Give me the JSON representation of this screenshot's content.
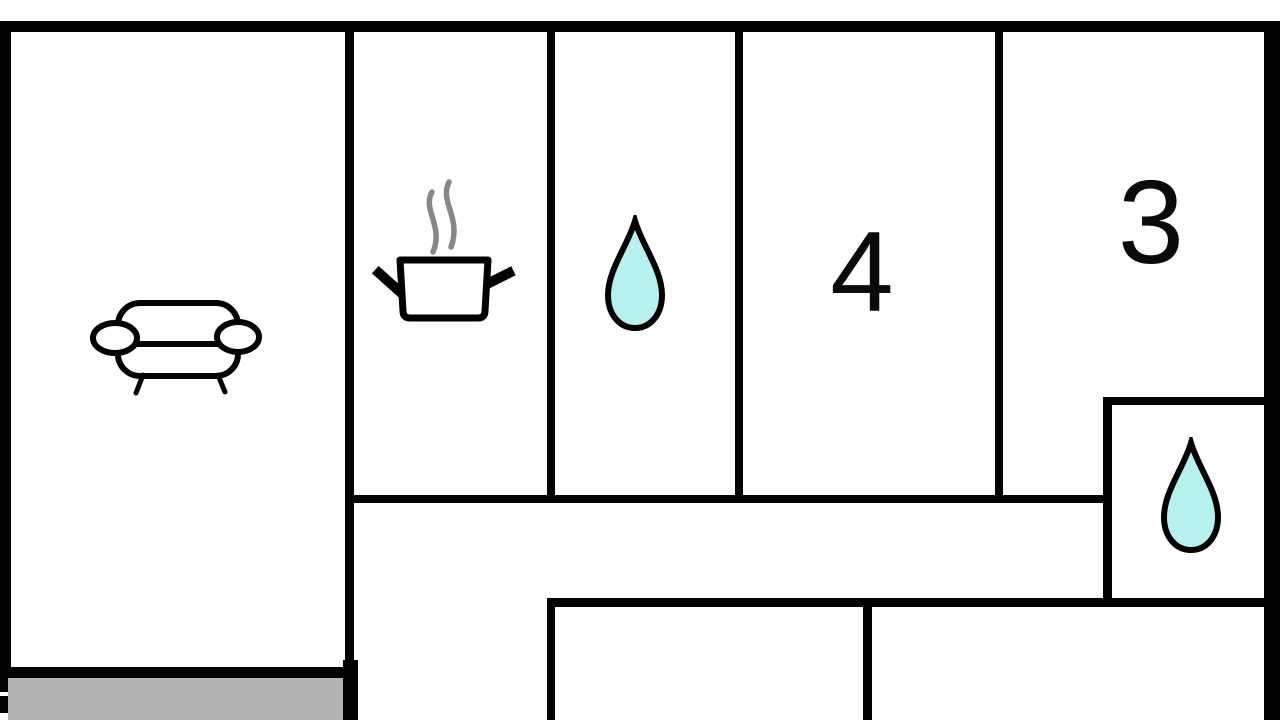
{
  "title": "apartment-floor-plan",
  "colors": {
    "background": "#ffffff",
    "wall": "#000000",
    "terrace": "#b4b4b4",
    "water": "#b7f1ef",
    "steam": "#878787"
  },
  "rooms": {
    "living_room": {
      "icon": "sofa-icon",
      "label": ""
    },
    "kitchen": {
      "icon": "cooking-pot-icon",
      "label": ""
    },
    "bathroom_top": {
      "icon": "water-drop-icon",
      "label": ""
    },
    "bedroom_4": {
      "label": "4"
    },
    "bedroom_3": {
      "label": "3"
    },
    "bathroom_right": {
      "icon": "water-drop-icon",
      "label": ""
    },
    "hallway": {
      "label": ""
    },
    "terrace": {
      "label": ""
    }
  }
}
